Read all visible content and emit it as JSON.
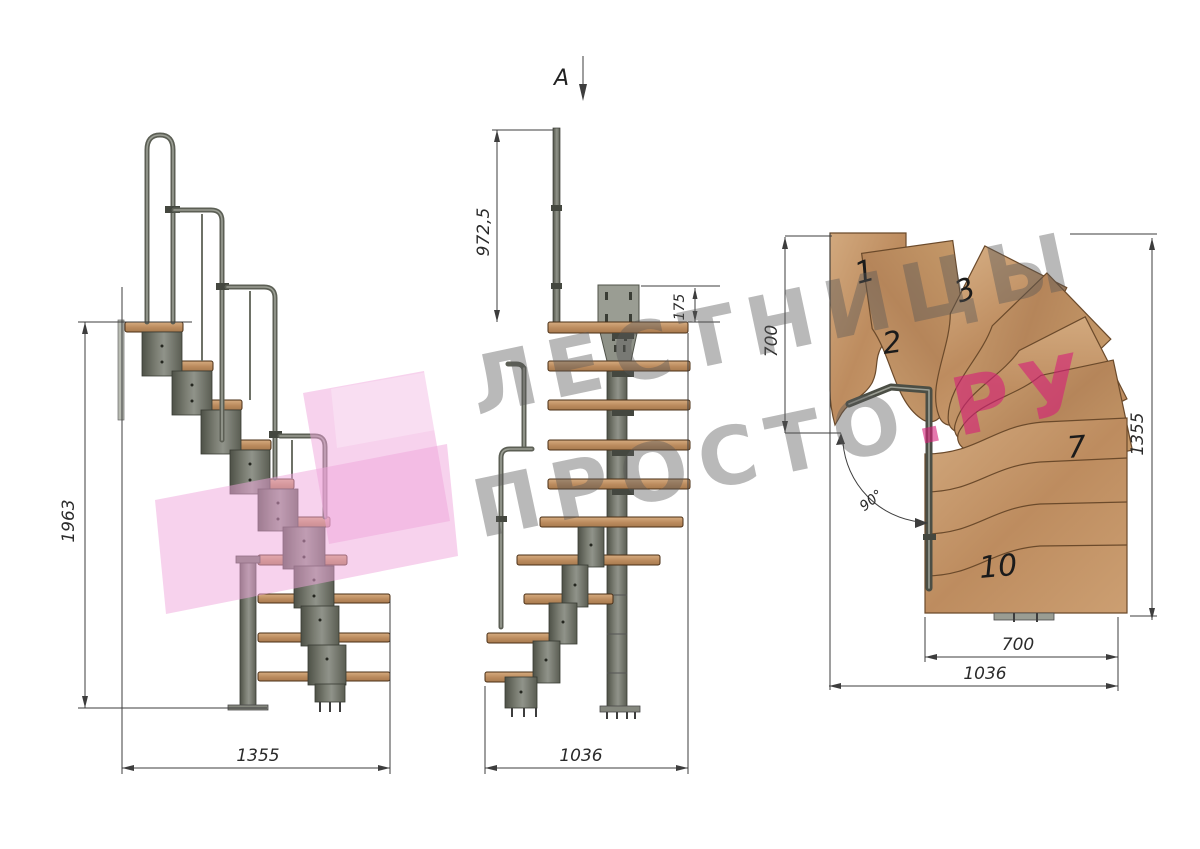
{
  "watermark": {
    "line1": "ЛЕСТНИЦЫ",
    "line2": "ПРОСТО",
    "line2_suffix": ".РУ",
    "text_color_hex": "#8a8a8a",
    "suffix_color_hex": "#d6307d",
    "logo_color_hex": "#f0b5de"
  },
  "section_cut": {
    "label": "A"
  },
  "side_view": {
    "dim_height": "1963",
    "dim_width": "1355"
  },
  "front_view": {
    "dim_rail_height": "972,5",
    "dim_plate_offset": "175",
    "dim_width": "1036"
  },
  "plan_view": {
    "dim_flight_width": "700",
    "dim_depth": "1355",
    "dim_lower_flight_width": "700",
    "dim_total_width": "1036",
    "dim_turn_angle": "90°",
    "tread_numbers": [
      "1",
      "2",
      "3",
      "7",
      "10"
    ]
  },
  "colors": {
    "wood_hex": "#c2966c",
    "metal_hex": "#6e7167",
    "dimension_hex": "#3d3d3d"
  }
}
